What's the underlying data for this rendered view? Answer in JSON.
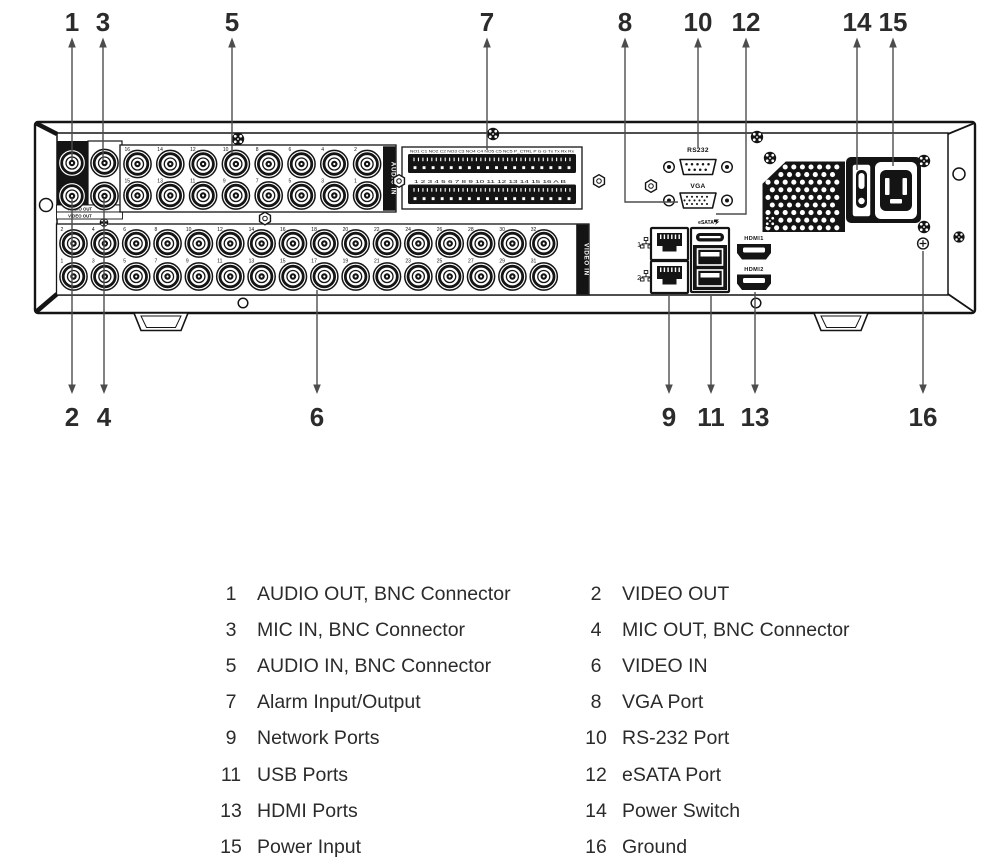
{
  "panel": {
    "audio_out_label": "AUDIO OUT",
    "video_out_label": "VIDEO OUT",
    "audio_in_strip": "AUDIO IN",
    "video_in_strip": "VIDEO IN",
    "alarm_row1_labels": "NO1 C1 NO2 C2 NO3 C3 NO4 C4 NO5 C5  NC5  P_CTRL P G G Tx Tx Rx Rx",
    "alarm_row2_labels": "1 2 3 4 5 6 7 8 9 10 11 12 13 14 15 16 A B",
    "rs232_label": "RS232",
    "vga_label": "VGA",
    "esata_label": "eSATA",
    "hdmi1_label": "HDMI1",
    "hdmi2_label": "HDMI2",
    "net1_label": "1",
    "net2_label": "2",
    "audio_in_numbers_top": [
      "16",
      "14",
      "12",
      "10",
      "8",
      "6",
      "4",
      "2"
    ],
    "audio_in_numbers_bottom": [
      "15",
      "13",
      "11",
      "9",
      "7",
      "5",
      "3",
      "1"
    ],
    "video_in_numbers_top": [
      "2",
      "4",
      "6",
      "8",
      "10",
      "12",
      "14",
      "16",
      "18",
      "20",
      "22",
      "24",
      "26",
      "28",
      "30",
      "32"
    ],
    "video_in_numbers_bottom": [
      "1",
      "3",
      "5",
      "7",
      "9",
      "11",
      "13",
      "15",
      "17",
      "19",
      "21",
      "23",
      "25",
      "27",
      "29",
      "31"
    ]
  },
  "callouts": {
    "top": [
      "1",
      "3",
      "5",
      "7",
      "8",
      "10",
      "12",
      "14",
      "15"
    ],
    "bottom": [
      "2",
      "4",
      "6",
      "9",
      "11",
      "13",
      "16"
    ]
  },
  "legend": {
    "left": [
      {
        "num": "1",
        "label": "AUDIO OUT, BNC Connector"
      },
      {
        "num": "3",
        "label": "MIC IN, BNC Connector"
      },
      {
        "num": "5",
        "label": "AUDIO IN, BNC Connector"
      },
      {
        "num": "7",
        "label": "Alarm Input/Output"
      },
      {
        "num": "9",
        "label": "Network Ports"
      },
      {
        "num": "11",
        "label": "USB Ports"
      },
      {
        "num": "13",
        "label": "HDMI Ports"
      },
      {
        "num": "15",
        "label": "Power Input"
      }
    ],
    "right": [
      {
        "num": "2",
        "label": "VIDEO OUT"
      },
      {
        "num": "4",
        "label": "MIC OUT, BNC Connector"
      },
      {
        "num": "6",
        "label": "VIDEO IN"
      },
      {
        "num": "8",
        "label": "VGA Port"
      },
      {
        "num": "10",
        "label": "RS-232 Port"
      },
      {
        "num": "12",
        "label": "eSATA Port"
      },
      {
        "num": "14",
        "label": "Power Switch"
      },
      {
        "num": "16",
        "label": "Ground"
      }
    ]
  },
  "colors": {
    "ink": "#141414",
    "callout_line": "#4d4d4d",
    "text": "#2b2b2b"
  }
}
